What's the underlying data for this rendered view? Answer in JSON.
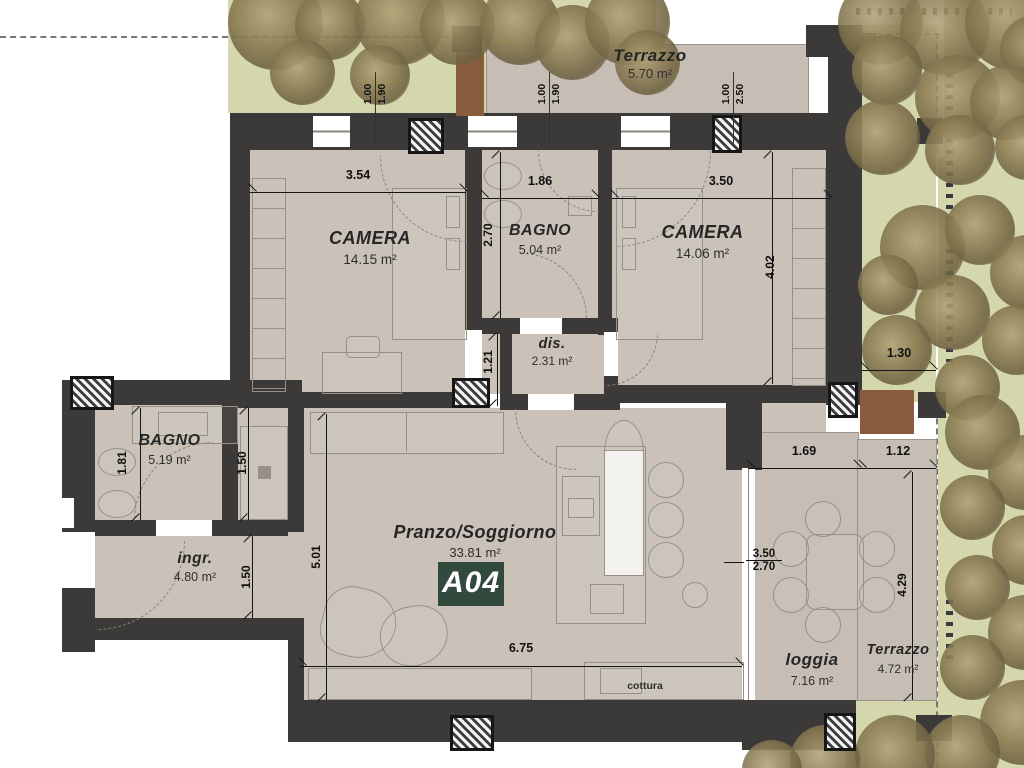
{
  "plan": {
    "unit_badge": "A04",
    "kitchen_label": "cottura",
    "rooms": [
      {
        "name": "Terrazzo",
        "area": "5.70 m²"
      },
      {
        "name": "CAMERA",
        "area": "14.15 m²"
      },
      {
        "name": "BAGNO",
        "area": "5.04 m²"
      },
      {
        "name": "CAMERA",
        "area": "14.06 m²"
      },
      {
        "name": "dis.",
        "area": "2.31 m²"
      },
      {
        "name": "BAGNO",
        "area": "5.19 m²"
      },
      {
        "name": "ingr.",
        "area": "4.80 m²"
      },
      {
        "name": "Pranzo/Soggiorno",
        "area": "33.81 m²"
      },
      {
        "name": "loggia",
        "area": "7.16 m²"
      },
      {
        "name": "Terrazzo",
        "area": "4.72 m²"
      }
    ],
    "dims": {
      "w_camera1": "3.54",
      "w_bagno1": "1.86",
      "w_camera2": "3.50",
      "h_bagno1": "2.70",
      "h_camera2": "4.02",
      "h_dis": "1.21",
      "h_bagno2": "1.81",
      "h_shower": "1.50",
      "h_ingresso": "1.50",
      "h_living": "5.01",
      "w_living": "6.75",
      "w_loggia": "1.69",
      "w_terrazzo2": "1.12",
      "w_side_gap": "1.30",
      "h_terrazzo2": "4.29",
      "frac_top": "3.50",
      "frac_bottom": "2.70",
      "pair1_a": "1.00",
      "pair1_b": "1.90",
      "pair2_a": "1.00",
      "pair2_b": "1.90",
      "pair3_a": "1.00",
      "pair3_b": "2.50"
    },
    "colors": {
      "wall": "#3b3a38",
      "floor": "#cac2b8",
      "garden": "#d4d6ab",
      "badge": "#32493e",
      "planter": "#8a5c3e"
    }
  }
}
